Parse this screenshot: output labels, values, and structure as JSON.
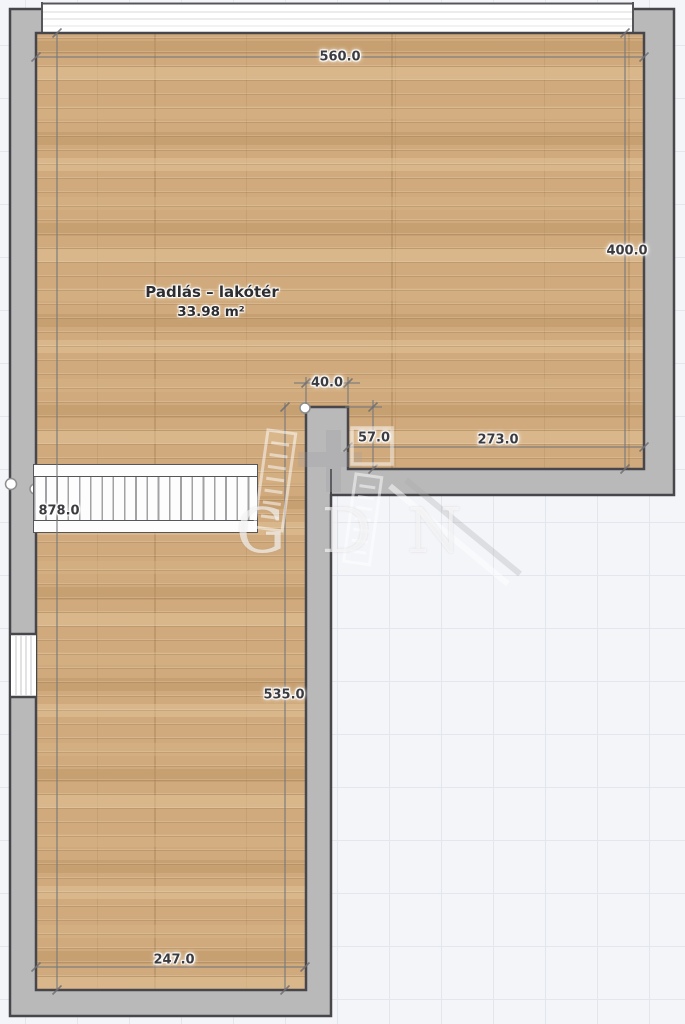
{
  "plan": {
    "room": {
      "name": "Padlás – lakótér",
      "area": "33.98 m²"
    },
    "dimensions": {
      "top_width": "560.0",
      "right_height": "400.0",
      "left_height": "878.0",
      "notch_width": "40.0",
      "notch_height": "57.0",
      "inner_bottom_width": "273.0",
      "wing_height": "535.0",
      "bottom_width": "247.0"
    },
    "watermark": {
      "text": "GDN"
    },
    "colors": {
      "background": "#f4f5f9",
      "grid_line": "#e4e6ef",
      "wall": "#b9b9ba",
      "outline": "#47474b",
      "floor_wood": "#d0aa7c",
      "dimension_line": "#78787c",
      "label_text": "#3c3c40"
    }
  }
}
